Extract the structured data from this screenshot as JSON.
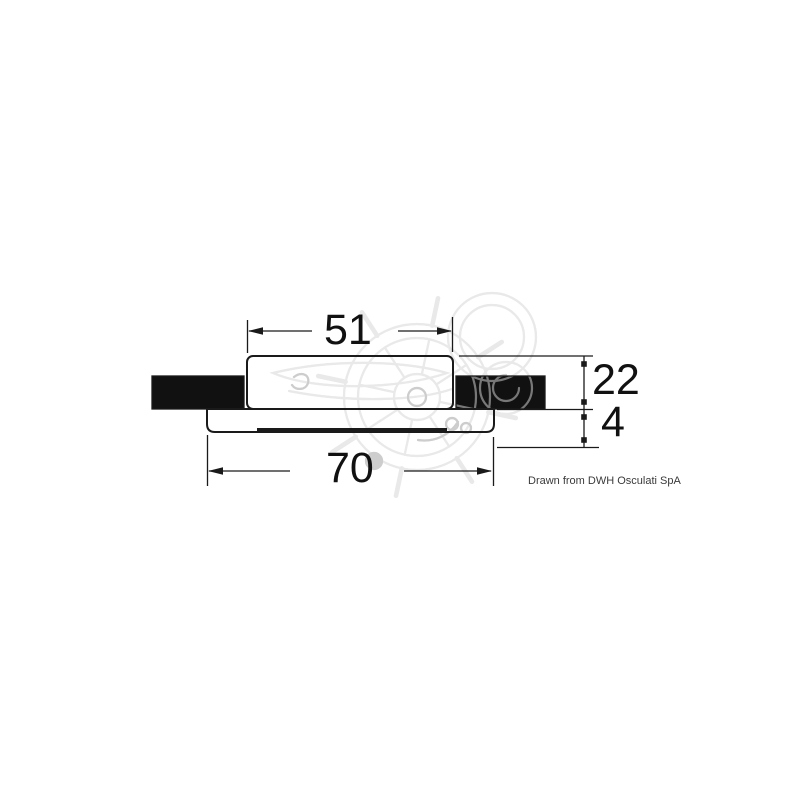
{
  "drawing": {
    "title": "recessed-light-cross-section",
    "dim_body_width": "51",
    "dim_flange_width": "70",
    "dim_body_height": "22",
    "dim_flange_thickness": "4",
    "credit": "Drawn from DWH Osculati SpA",
    "watermark": "osculati-ship-wheel-logo",
    "colors": {
      "line": "#1a1a1a",
      "panel_fill": "#111111",
      "watermark_light": "#d8d8d8",
      "watermark_on_black": "#707070"
    }
  }
}
